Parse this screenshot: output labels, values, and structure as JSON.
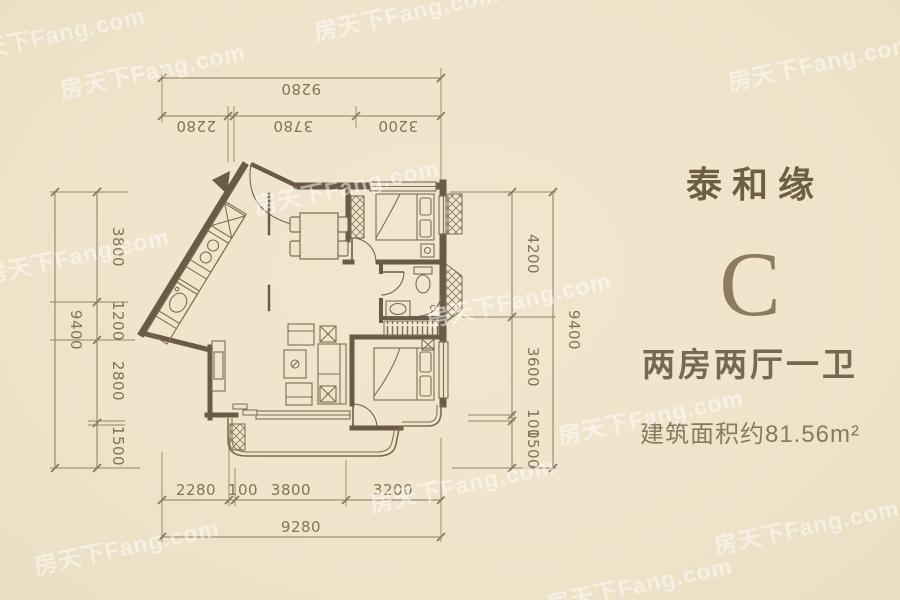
{
  "panel": {
    "project": "泰和缘",
    "unit": "C",
    "rooms": "两房两厅一卫",
    "area": "建筑面积约81.56m²"
  },
  "dims": {
    "top": {
      "total": "9280",
      "segments": [
        "2280",
        "3780",
        "3200"
      ]
    },
    "bottom": {
      "total": "9280",
      "segments": [
        "2280",
        "100",
        "3800",
        "3200"
      ]
    },
    "left": {
      "total": "9400",
      "segments": [
        "3800",
        "1200",
        "2800",
        "1500"
      ]
    },
    "right": {
      "total": "9400",
      "segments": [
        "4200",
        "3600",
        "100",
        "1500"
      ]
    }
  },
  "watermark": {
    "text": "房天下Fang.com"
  },
  "colors": {
    "background": "#efe3cb",
    "wall": "#6b5b46",
    "furniture_line": "#7d6c54",
    "dimension_line": "#8a7a5e",
    "dimension_text": "#83735a",
    "project_text": "#6f5e46",
    "unit_letter": "#8d7c63",
    "watermark": "rgba(255,255,255,0.5)"
  }
}
